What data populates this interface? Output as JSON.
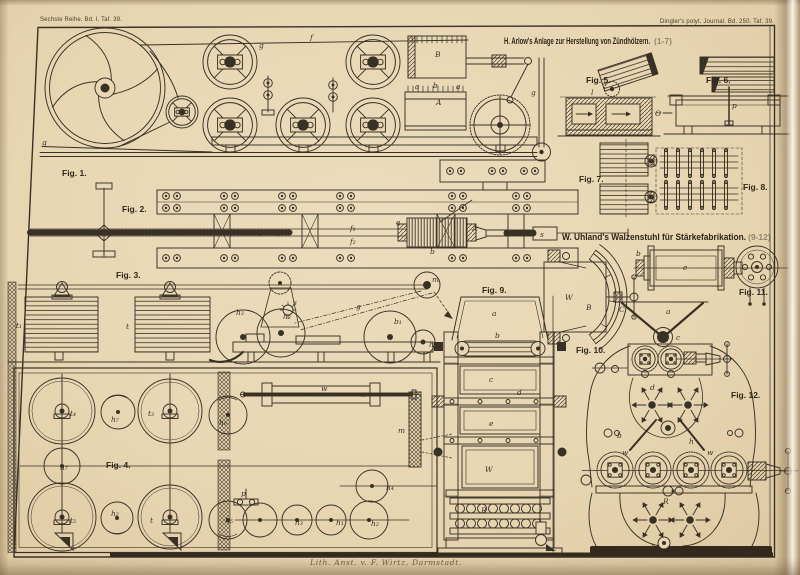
{
  "plate": {
    "header_left": "Sechste Reihe. Bd. I. Taf. 39.",
    "header_right": "Dingler's polyt. Journal. Bd. 250. Taf. 39.",
    "caption": "Lith. Anst. v. F. Wirtz, Darmstadt.",
    "colors": {
      "paper": "#e8d6b3",
      "ink": "#3a3126",
      "edge_dark": "#b99c74",
      "edge_light": "#f2e8d2"
    }
  },
  "titles": [
    {
      "text": "H. Arlow's Anlage zur Herstellung von Zündhölzern.",
      "suffix": "(1-7)"
    },
    {
      "text": "W. Uhland's Walzenstuhl für Stärkefabrikation.",
      "suffix": "(9-12)"
    }
  ],
  "figures": [
    {
      "label": "Fig. 1."
    },
    {
      "label": "Fig. 2."
    },
    {
      "label": "Fig. 3."
    },
    {
      "label": "Fig. 4."
    },
    {
      "label": "Fig. 5."
    },
    {
      "label": "Fig. 6."
    },
    {
      "label": "Fig. 7."
    },
    {
      "label": "Fig. 8."
    },
    {
      "label": "Fig. 9."
    },
    {
      "label": "Fig. 10."
    },
    {
      "label": "Fig. 11."
    },
    {
      "label": "Fig. 12."
    }
  ],
  "letters": [
    {
      "t": "g"
    },
    {
      "t": "g"
    },
    {
      "t": "f"
    },
    {
      "t": "B"
    },
    {
      "t": "A"
    },
    {
      "t": "g"
    },
    {
      "t": "l"
    },
    {
      "t": "Θ"
    },
    {
      "t": "p"
    },
    {
      "t": "e"
    },
    {
      "t": "A"
    },
    {
      "t": "f₁"
    },
    {
      "t": "f₂"
    },
    {
      "t": "b"
    },
    {
      "t": "s"
    },
    {
      "t": "t₁"
    },
    {
      "t": "t"
    },
    {
      "t": "h₃"
    },
    {
      "t": "h₂"
    },
    {
      "t": "s"
    },
    {
      "t": "g"
    },
    {
      "t": "m"
    },
    {
      "t": "b₁"
    },
    {
      "t": "h"
    },
    {
      "t": "t₄"
    },
    {
      "t": "h₇"
    },
    {
      "t": "t₃"
    },
    {
      "t": "h₆"
    },
    {
      "t": "h₇"
    },
    {
      "t": "w"
    },
    {
      "t": "x"
    },
    {
      "t": "m"
    },
    {
      "t": "t₅"
    },
    {
      "t": "h₂"
    },
    {
      "t": "t"
    },
    {
      "t": "h₅"
    },
    {
      "t": "p"
    },
    {
      "t": "h₃"
    },
    {
      "t": "h₁"
    },
    {
      "t": "h₂"
    },
    {
      "t": "h₄"
    },
    {
      "t": "a"
    },
    {
      "t": "b"
    },
    {
      "t": "c"
    },
    {
      "t": "e"
    },
    {
      "t": "W"
    },
    {
      "t": "R"
    },
    {
      "t": "d"
    },
    {
      "t": "W"
    },
    {
      "t": "B"
    },
    {
      "t": "C"
    },
    {
      "t": "e"
    },
    {
      "t": "b"
    },
    {
      "t": "a"
    },
    {
      "t": "c"
    },
    {
      "t": "d"
    },
    {
      "t": "b"
    },
    {
      "t": "h"
    },
    {
      "t": "w"
    },
    {
      "t": "w"
    },
    {
      "t": "R"
    },
    {
      "t": "k"
    },
    {
      "t": "a"
    },
    {
      "t": "b"
    },
    {
      "t": "a"
    }
  ]
}
